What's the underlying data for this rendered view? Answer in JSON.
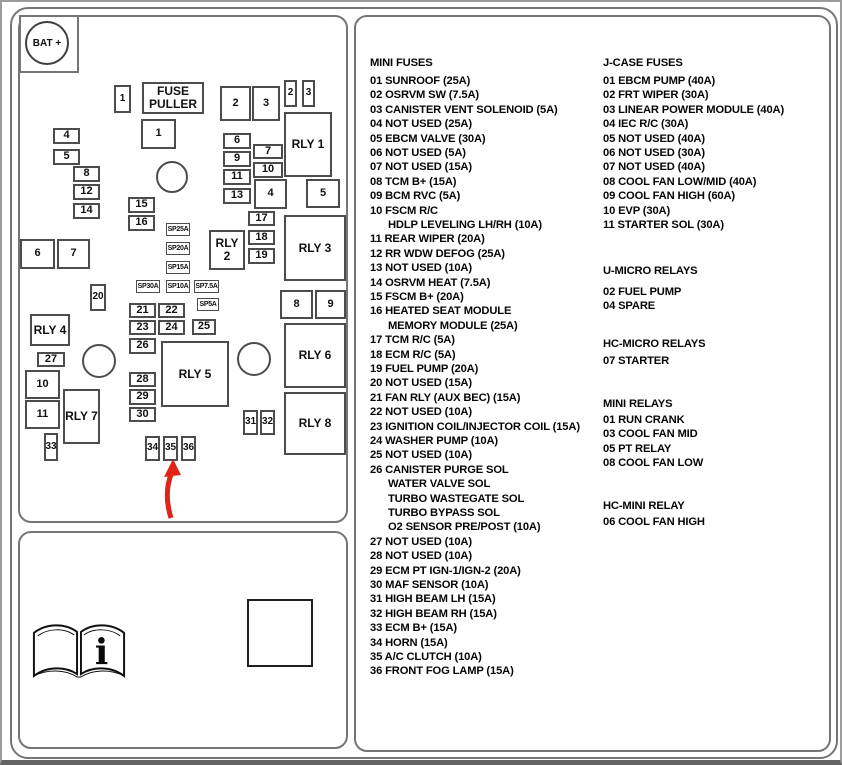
{
  "diagram": {
    "bat": {
      "label": "BAT +"
    },
    "arrow": {
      "color": "#e02417",
      "points_to": "35"
    },
    "boxes": [
      {
        "l": "1",
        "x": 112,
        "y": 83,
        "w": 17,
        "h": 28,
        "c": "xs",
        "name": "fuse-box-1-small"
      },
      {
        "l": "FUSE PULLER",
        "x": 140,
        "y": 80,
        "w": 62,
        "h": 32,
        "c": "fp",
        "name": "fuse-puller"
      },
      {
        "l": "1",
        "x": 139,
        "y": 117,
        "w": 35,
        "h": 30,
        "name": "fuse-box-1"
      },
      {
        "l": "2",
        "x": 218,
        "y": 84,
        "w": 31,
        "h": 35
      },
      {
        "l": "3",
        "x": 250,
        "y": 84,
        "w": 28,
        "h": 35
      },
      {
        "l": "2",
        "x": 282,
        "y": 78,
        "w": 13,
        "h": 27,
        "c": "xs"
      },
      {
        "l": "3",
        "x": 300,
        "y": 78,
        "w": 13,
        "h": 27,
        "c": "xs"
      },
      {
        "l": "RLY 1",
        "x": 282,
        "y": 110,
        "w": 48,
        "h": 65,
        "c": "rly"
      },
      {
        "l": "4",
        "x": 51,
        "y": 126,
        "w": 27,
        "h": 16,
        "c": "s"
      },
      {
        "l": "5",
        "x": 51,
        "y": 147,
        "w": 27,
        "h": 16,
        "c": "s"
      },
      {
        "l": "8",
        "x": 71,
        "y": 164,
        "w": 27,
        "h": 16,
        "c": "s"
      },
      {
        "l": "12",
        "x": 71,
        "y": 182,
        "w": 27,
        "h": 16,
        "c": "s"
      },
      {
        "l": "14",
        "x": 71,
        "y": 201,
        "w": 27,
        "h": 16,
        "c": "s"
      },
      {
        "l": "6",
        "x": 221,
        "y": 131,
        "w": 28,
        "h": 16,
        "c": "s"
      },
      {
        "l": "7",
        "x": 251,
        "y": 142,
        "w": 30,
        "h": 15,
        "c": "s"
      },
      {
        "l": "9",
        "x": 221,
        "y": 149,
        "w": 28,
        "h": 16,
        "c": "s"
      },
      {
        "l": "10",
        "x": 251,
        "y": 160,
        "w": 30,
        "h": 16,
        "c": "s"
      },
      {
        "l": "11",
        "x": 221,
        "y": 167,
        "w": 28,
        "h": 16,
        "c": "s"
      },
      {
        "l": "13",
        "x": 221,
        "y": 186,
        "w": 28,
        "h": 16,
        "c": "s"
      },
      {
        "l": "4",
        "x": 252,
        "y": 177,
        "w": 33,
        "h": 30
      },
      {
        "l": "5",
        "x": 304,
        "y": 177,
        "w": 34,
        "h": 29
      },
      {
        "l": "15",
        "x": 126,
        "y": 195,
        "w": 27,
        "h": 16,
        "c": "s"
      },
      {
        "l": "16",
        "x": 126,
        "y": 213,
        "w": 27,
        "h": 16,
        "c": "s"
      },
      {
        "l": "17",
        "x": 246,
        "y": 209,
        "w": 27,
        "h": 15,
        "c": "s"
      },
      {
        "l": "18",
        "x": 246,
        "y": 228,
        "w": 27,
        "h": 15,
        "c": "s"
      },
      {
        "l": "19",
        "x": 246,
        "y": 246,
        "w": 27,
        "h": 16,
        "c": "s"
      },
      {
        "l": "RLY 2",
        "x": 207,
        "y": 228,
        "w": 36,
        "h": 40,
        "c": "rly"
      },
      {
        "l": "RLY 3",
        "x": 282,
        "y": 213,
        "w": 62,
        "h": 66,
        "c": "rly"
      },
      {
        "l": "SP25A",
        "x": 164,
        "y": 221,
        "w": 24,
        "h": 13,
        "c": "sp"
      },
      {
        "l": "SP20A",
        "x": 164,
        "y": 240,
        "w": 24,
        "h": 13,
        "c": "sp"
      },
      {
        "l": "SP15A",
        "x": 164,
        "y": 259,
        "w": 24,
        "h": 13,
        "c": "sp"
      },
      {
        "l": "SP30A",
        "x": 134,
        "y": 278,
        "w": 24,
        "h": 13,
        "c": "sp"
      },
      {
        "l": "SP10A",
        "x": 164,
        "y": 278,
        "w": 24,
        "h": 13,
        "c": "sp"
      },
      {
        "l": "SP7.5A",
        "x": 192,
        "y": 278,
        "w": 25,
        "h": 13,
        "c": "sp"
      },
      {
        "l": "SP5A",
        "x": 195,
        "y": 296,
        "w": 22,
        "h": 13,
        "c": "sp"
      },
      {
        "l": "6",
        "x": 18,
        "y": 237,
        "w": 35,
        "h": 30
      },
      {
        "l": "7",
        "x": 55,
        "y": 237,
        "w": 33,
        "h": 30
      },
      {
        "l": "20",
        "x": 88,
        "y": 282,
        "w": 16,
        "h": 27,
        "c": "xs"
      },
      {
        "l": "RLY 4",
        "x": 28,
        "y": 312,
        "w": 40,
        "h": 32,
        "c": "rly"
      },
      {
        "l": "27",
        "x": 35,
        "y": 350,
        "w": 28,
        "h": 15,
        "c": "s"
      },
      {
        "l": "10",
        "x": 23,
        "y": 368,
        "w": 35,
        "h": 29
      },
      {
        "l": "11",
        "x": 23,
        "y": 398,
        "w": 35,
        "h": 29
      },
      {
        "l": "RLY 7",
        "x": 61,
        "y": 387,
        "w": 37,
        "h": 55,
        "c": "rly"
      },
      {
        "l": "33",
        "x": 42,
        "y": 431,
        "w": 14,
        "h": 28,
        "c": "xs"
      },
      {
        "l": "21",
        "x": 127,
        "y": 301,
        "w": 27,
        "h": 15,
        "c": "s"
      },
      {
        "l": "22",
        "x": 156,
        "y": 301,
        "w": 27,
        "h": 15,
        "c": "s"
      },
      {
        "l": "23",
        "x": 127,
        "y": 318,
        "w": 27,
        "h": 15,
        "c": "s"
      },
      {
        "l": "24",
        "x": 156,
        "y": 318,
        "w": 27,
        "h": 15,
        "c": "s"
      },
      {
        "l": "25",
        "x": 190,
        "y": 317,
        "w": 24,
        "h": 16,
        "c": "s"
      },
      {
        "l": "26",
        "x": 127,
        "y": 336,
        "w": 27,
        "h": 16,
        "c": "s"
      },
      {
        "l": "28",
        "x": 127,
        "y": 370,
        "w": 27,
        "h": 15,
        "c": "s"
      },
      {
        "l": "29",
        "x": 127,
        "y": 387,
        "w": 27,
        "h": 16,
        "c": "s"
      },
      {
        "l": "30",
        "x": 127,
        "y": 405,
        "w": 27,
        "h": 15,
        "c": "s"
      },
      {
        "l": "RLY 5",
        "x": 159,
        "y": 339,
        "w": 68,
        "h": 66,
        "c": "rly"
      },
      {
        "l": "8",
        "x": 278,
        "y": 288,
        "w": 33,
        "h": 29
      },
      {
        "l": "9",
        "x": 313,
        "y": 288,
        "w": 31,
        "h": 29
      },
      {
        "l": "RLY 6",
        "x": 282,
        "y": 321,
        "w": 62,
        "h": 65,
        "c": "rly"
      },
      {
        "l": "RLY 8",
        "x": 282,
        "y": 390,
        "w": 62,
        "h": 63,
        "c": "rly"
      },
      {
        "l": "31",
        "x": 241,
        "y": 408,
        "w": 15,
        "h": 25,
        "c": "xs"
      },
      {
        "l": "32",
        "x": 258,
        "y": 408,
        "w": 15,
        "h": 25,
        "c": "xs"
      },
      {
        "l": "34",
        "x": 143,
        "y": 434,
        "w": 15,
        "h": 25,
        "c": "xs"
      },
      {
        "l": "35",
        "x": 161,
        "y": 434,
        "w": 15,
        "h": 25,
        "c": "xs"
      },
      {
        "l": "36",
        "x": 179,
        "y": 434,
        "w": 15,
        "h": 25,
        "c": "xs"
      }
    ],
    "circles": [
      {
        "x": 170,
        "y": 175,
        "r": 16
      },
      {
        "x": 97,
        "y": 359,
        "r": 17
      },
      {
        "x": 252,
        "y": 357,
        "r": 17
      }
    ]
  },
  "legend": {
    "columns": [
      {
        "x": 368,
        "sections": [
          {
            "title": "MINI FUSES",
            "title_top": 55,
            "items_top": 73,
            "line_pitch": 14.4,
            "lines": [
              {
                "t": "01 SUNROOF (25A)"
              },
              {
                "t": "02 OSRVM SW (7.5A)"
              },
              {
                "t": "03 CANISTER VENT SOLENOID (5A)"
              },
              {
                "t": "04 NOT USED (25A)"
              },
              {
                "t": "05 EBCM VALVE (30A)"
              },
              {
                "t": "06 NOT USED (5A)"
              },
              {
                "t": "07 NOT USED (15A)"
              },
              {
                "t": "08 TCM B+ (15A)"
              },
              {
                "t": "09 BCM RVC (5A)"
              },
              {
                "t": "10 FSCM R/C"
              },
              {
                "t": "HDLP LEVELING LH/RH (10A)",
                "indent": true
              },
              {
                "t": "11 REAR WIPER (20A)"
              },
              {
                "t": "12 RR WDW DEFOG (25A)"
              },
              {
                "t": "13 NOT USED (10A)"
              },
              {
                "t": "14 OSRVM HEAT (7.5A)"
              },
              {
                "t": "15 FSCM B+ (20A)"
              },
              {
                "t": "16 HEATED SEAT MODULE"
              },
              {
                "t": "MEMORY MODULE (25A)",
                "indent": true
              },
              {
                "t": "17 TCM R/C (5A)"
              },
              {
                "t": "18 ECM R/C (5A)"
              },
              {
                "t": "19 FUEL PUMP (20A)"
              },
              {
                "t": "20 NOT USED (15A)"
              },
              {
                "t": "21 FAN RLY (AUX BEC) (15A)"
              },
              {
                "t": "22 NOT USED (10A)"
              },
              {
                "t": "23 IGNITION COIL/INJECTOR COIL (15A)"
              },
              {
                "t": "24 WASHER PUMP (10A)"
              },
              {
                "t": "25 NOT USED (10A)"
              },
              {
                "t": "26 CANISTER PURGE SOL"
              },
              {
                "t": "WATER VALVE SOL",
                "indent": true
              },
              {
                "t": "TURBO WASTEGATE SOL",
                "indent": true
              },
              {
                "t": "TURBO BYPASS SOL",
                "indent": true
              },
              {
                "t": "O2 SENSOR PRE/POST (10A)",
                "indent": true
              },
              {
                "t": "27 NOT USED (10A)"
              },
              {
                "t": "28 NOT USED (10A)"
              },
              {
                "t": "29 ECM PT IGN-1/IGN-2 (20A)"
              },
              {
                "t": "30 MAF SENSOR (10A)"
              },
              {
                "t": "31 HIGH BEAM LH (15A)"
              },
              {
                "t": "32 HIGH BEAM RH (15A)"
              },
              {
                "t": "33 ECM B+ (15A)"
              },
              {
                "t": "34 HORN (15A)"
              },
              {
                "t": "35 A/C CLUTCH (10A)"
              },
              {
                "t": "36 FRONT FOG LAMP (15A)"
              }
            ]
          }
        ]
      },
      {
        "x": 601,
        "sections": [
          {
            "title": "J-CASE FUSES",
            "title_top": 55,
            "items_top": 73,
            "line_pitch": 14.4,
            "lines": [
              {
                "t": "01 EBCM PUMP (40A)"
              },
              {
                "t": "02 FRT WIPER (30A)"
              },
              {
                "t": "03 LINEAR POWER MODULE (40A)"
              },
              {
                "t": "04 IEC R/C (30A)"
              },
              {
                "t": "05 NOT USED (40A)"
              },
              {
                "t": "06 NOT USED (30A)"
              },
              {
                "t": "07 NOT USED (40A)"
              },
              {
                "t": "08 COOL FAN LOW/MID (40A)"
              },
              {
                "t": "09 COOL FAN HIGH (60A)"
              },
              {
                "t": "10 EVP (30A)"
              },
              {
                "t": "11 STARTER SOL (30A)"
              }
            ]
          },
          {
            "title": "U-MICRO RELAYS",
            "title_top": 263,
            "items_top": 284,
            "line_pitch": 14.4,
            "lines": [
              {
                "t": "02 FUEL PUMP"
              },
              {
                "t": "04 SPARE"
              }
            ]
          },
          {
            "title": "HC-MICRO RELAYS",
            "title_top": 336,
            "items_top": 353,
            "line_pitch": 14.4,
            "lines": [
              {
                "t": "07 STARTER"
              }
            ]
          },
          {
            "title": "MINI RELAYS",
            "title_top": 396,
            "items_top": 412,
            "line_pitch": 14.4,
            "lines": [
              {
                "t": "01 RUN CRANK"
              },
              {
                "t": "03 COOL FAN MID"
              },
              {
                "t": "05 PT RELAY"
              },
              {
                "t": "08 COOL FAN LOW"
              }
            ]
          },
          {
            "title": "HC-MINI RELAY",
            "title_top": 498,
            "items_top": 514,
            "line_pitch": 14.4,
            "lines": [
              {
                "t": "06 COOL FAN HIGH"
              }
            ]
          }
        ]
      }
    ]
  }
}
